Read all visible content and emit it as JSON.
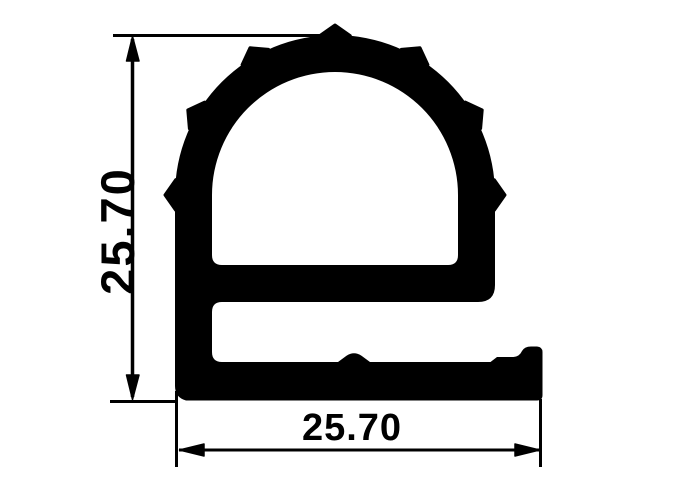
{
  "drawing": {
    "height_dimension_label": "25.70",
    "width_dimension_label": "25.70"
  },
  "colors": {
    "ink": "#000000",
    "background": "#ffffff"
  }
}
